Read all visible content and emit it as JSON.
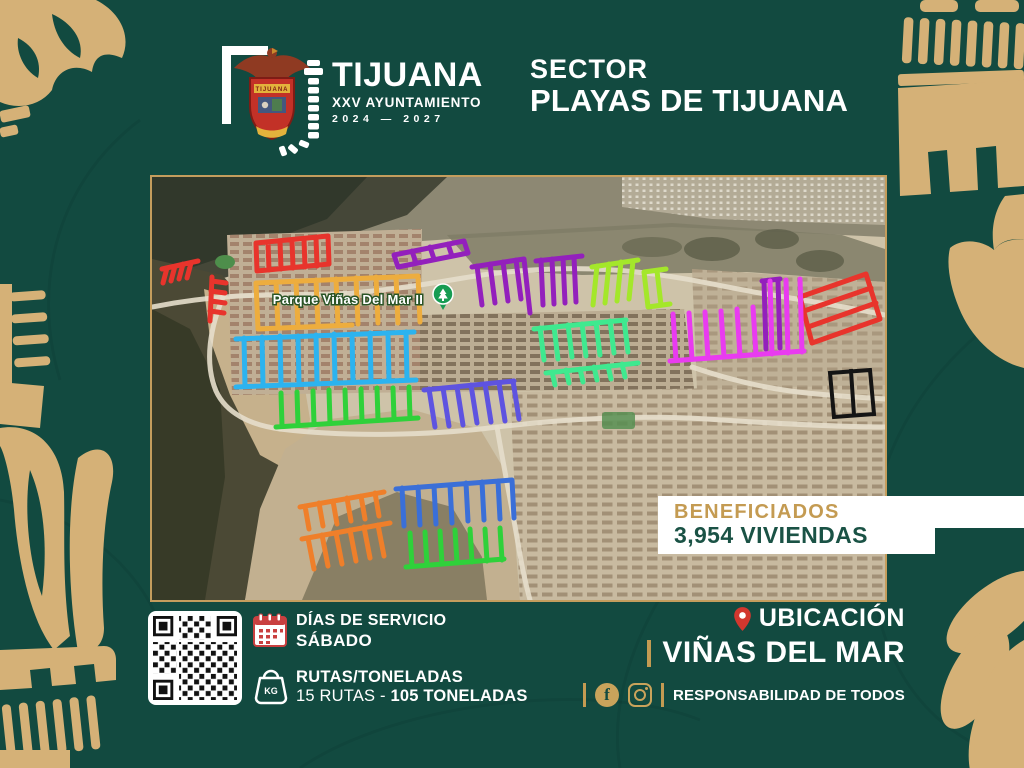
{
  "theme": {
    "bg_green": "#124A40",
    "gold": "#D5B177",
    "gold_dark": "#C49B52",
    "badge_label_color": "#C49B52",
    "badge_value_color": "#1A5245",
    "pin_red": "#D2372E"
  },
  "header": {
    "brand_name": "TIJUANA",
    "brand_subtitle": "XXV AYUNTAMIENTO",
    "brand_period": "2024 — 2027",
    "crest_text": "TIJUANA",
    "sector_label": "SECTOR",
    "sector_name": "PLAYAS DE TIJUANA"
  },
  "map": {
    "park_label": "Parque Viñas Del Mar II",
    "route_colors": {
      "red": "#E8342C",
      "yellow": "#EDAD3E",
      "orange": "#EF7F2A",
      "cyan": "#2CB3EF",
      "blue": "#3A6FD8",
      "indigo": "#5E53E0",
      "purple": "#9320BC",
      "magenta": "#E93BF0",
      "lime": "#A4E72A",
      "mint": "#3FE98F",
      "green": "#2FD13A",
      "black": "#141414"
    }
  },
  "badge": {
    "label": "BENEFICIADOS",
    "value": "3,954 VIVIENDAS"
  },
  "footer": {
    "service": {
      "label": "DÍAS DE SERVICIO",
      "value": "SÁBADO"
    },
    "routes": {
      "label": "RUTAS/TONELADAS",
      "value_prefix": "15 RUTAS - ",
      "value_bold": "105 TONELADAS"
    },
    "location": {
      "label": "UBICACIÓN",
      "value": "VIÑAS DEL MAR"
    },
    "tagline": "RESPONSABILIDAD DE TODOS",
    "kg_label": "KG",
    "facebook_glyph": "f"
  }
}
